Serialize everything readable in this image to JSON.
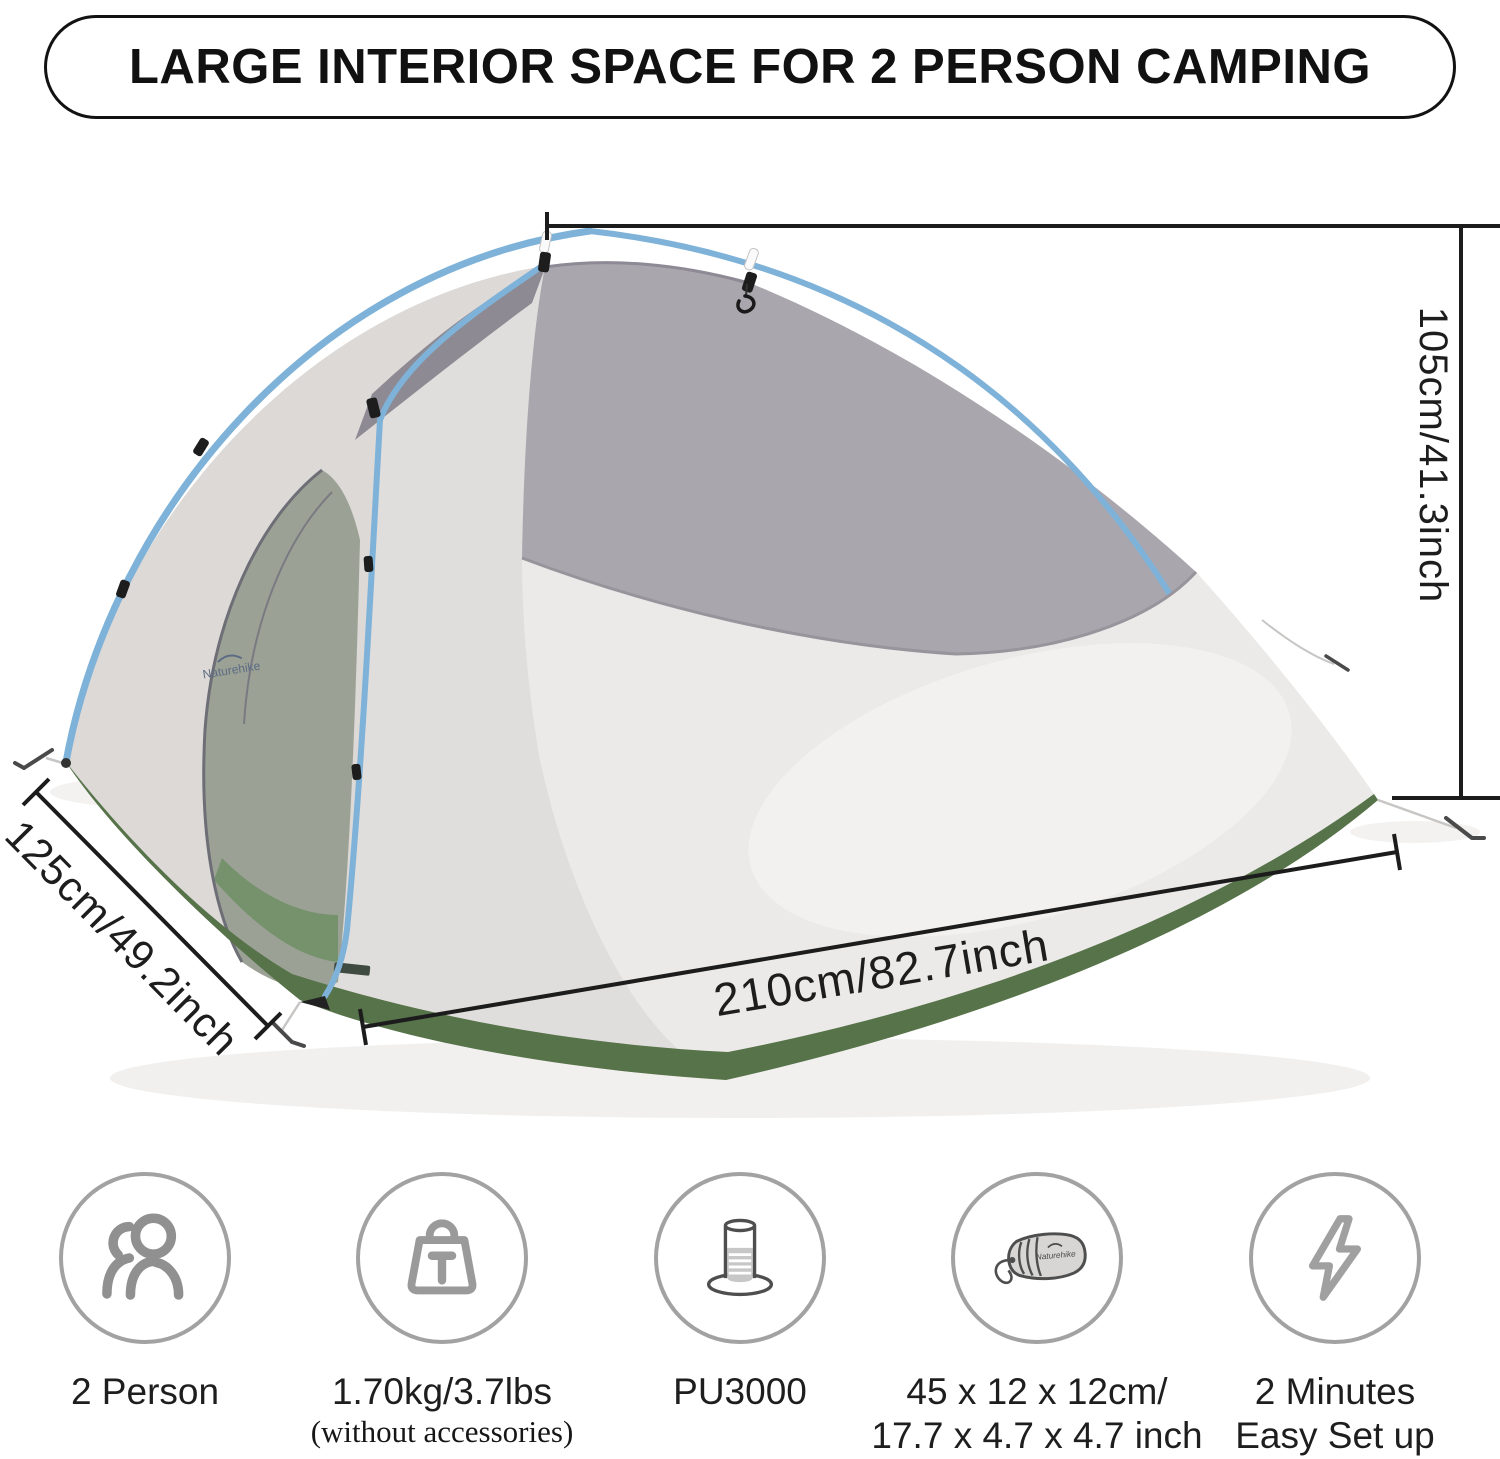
{
  "title": "LARGE INTERIOR SPACE FOR 2 PERSON CAMPING",
  "dimensions": {
    "height_label": "105cm/41.3inch",
    "width_label": "125cm/49.2inch",
    "length_label": "210cm/82.7inch"
  },
  "tent": {
    "brand_logo": "Naturehike"
  },
  "features": [
    {
      "icon": "two-person-icon",
      "line1": "2 Person",
      "line2": "",
      "note": ""
    },
    {
      "icon": "weight-icon",
      "line1": "1.70kg/3.7lbs",
      "line2": "",
      "note": "(without accessories)"
    },
    {
      "icon": "waterproof-rating-icon",
      "line1": "PU3000",
      "line2": "",
      "note": ""
    },
    {
      "icon": "packed-size-icon",
      "line1": "45 x 12 x 12cm/",
      "line2": "17.7 x 4.7 x 4.7 inch",
      "note": "",
      "bag_label": "Naturehike"
    },
    {
      "icon": "quick-setup-icon",
      "line1": "2 Minutes",
      "line2": "Easy Set up",
      "note": ""
    }
  ],
  "colors": {
    "tent_green": "#567349",
    "pole_blue": "#7fb2d8",
    "fabric_light": "#e0dedc",
    "fabric_bright": "#eceae8",
    "mesh_gray": "#aaa6ae",
    "mesh_dark": "#8e8a93",
    "dimension_line": "#1c1c1c",
    "icon_gray": "#8f8f8f"
  }
}
